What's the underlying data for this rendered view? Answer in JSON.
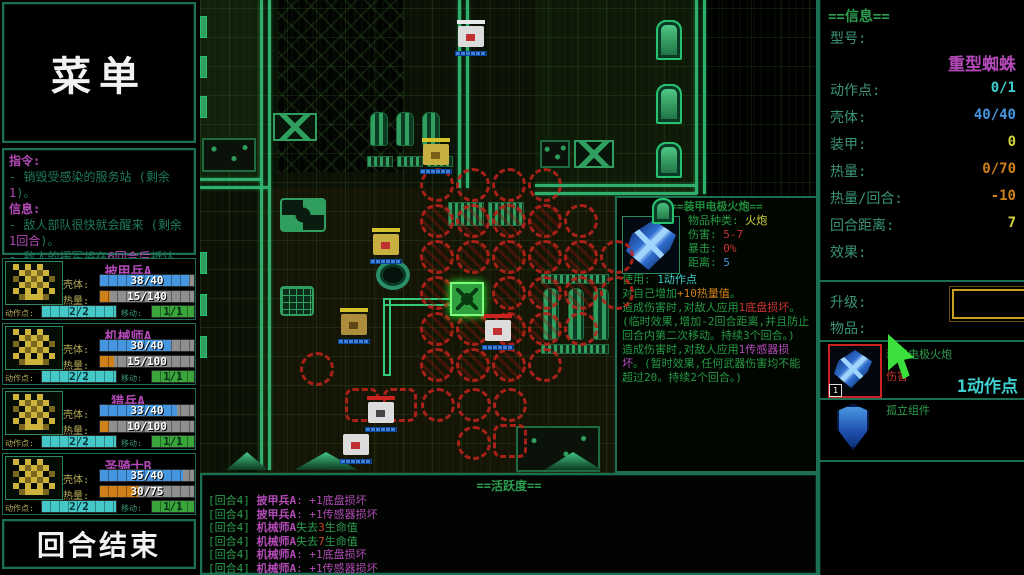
{
  "left_panel": {
    "menu_title": "菜单",
    "orders": {
      "header": "指令:",
      "line1_a": "- 销毁受感染的服务站 (剩余",
      "line1_b": "1",
      "line1_c": ")。"
    },
    "info": {
      "header": "信息:",
      "line1_a": "- 敌人部队很快就会醒来 (剩余",
      "line1_b": "1回合",
      "line1_c": ")。",
      "line2_a": "- 敌人的援军将在",
      "line2_b": "6回合后",
      "line2_c": "抵达。"
    },
    "labels": {
      "shell": "壳体:",
      "heat": "热量:",
      "ap": "动作点:",
      "move": "移动:"
    },
    "units": [
      {
        "name": "披甲兵A",
        "shell": "38/40",
        "shell_pct": 95,
        "heat": "15/140",
        "heat_pct": 11,
        "ap": "2/2",
        "move": "1/1"
      },
      {
        "name": "机械师A",
        "shell": "30/40",
        "shell_pct": 75,
        "heat": "15/100",
        "heat_pct": 15,
        "ap": "2/2",
        "move": "1/1"
      },
      {
        "name": "猎兵A",
        "shell": "33/40",
        "shell_pct": 82,
        "heat": "10/100",
        "heat_pct": 10,
        "ap": "2/2",
        "move": "1/1"
      },
      {
        "name": "圣骑士B",
        "shell": "35/40",
        "shell_pct": 88,
        "heat": "30/75",
        "heat_pct": 40,
        "ap": "2/2",
        "move": "1/1"
      }
    ],
    "end_turn_label": "回合结束"
  },
  "right_panel": {
    "info_title": "==信息==",
    "model_label": "型号:",
    "model_value": "重型蜘蛛",
    "fields": [
      {
        "label": "动作点:",
        "value": "0/1"
      },
      {
        "label": "壳体:",
        "value": "40/40"
      },
      {
        "label": "装甲:",
        "value": "0"
      },
      {
        "label": "热量:",
        "value": "0/70"
      },
      {
        "label": "热量/回合:",
        "value": "-10"
      },
      {
        "label": "回合距离:",
        "value": "7"
      }
    ],
    "effects_label": "效果:",
    "upgrade_label": "升级:",
    "items_label": "物品:",
    "item1": {
      "count": "1",
      "name": "装甲电极火炮",
      "stat_label": "伤害",
      "action_cost": "1动作点"
    },
    "item2": {
      "name": "孤立组件"
    }
  },
  "tooltip": {
    "title": "==装甲电极火炮==",
    "type_label": "物品种类:",
    "type_value": "火炮",
    "damage_label": "伤害:",
    "damage_value": "5-7",
    "crit_label": "暴击:",
    "crit_value": "0%",
    "range_label": "距离:",
    "range_value": "5",
    "use_label": "使用:",
    "use_value": "1动作点",
    "self_a": "对自己增加",
    "self_b": "+10热量值",
    "self_c": "。",
    "p1_a": "造成伤害时,对敌人应用",
    "p1_b": "1底盘损坏",
    "p1_c": "。(临时效果,增加-2回合距离,并且防止回合内第二次移动。持续3个回合。)",
    "p2_a": "造成伤害时,对敌人应用",
    "p2_b": "1传感器损坏",
    "p2_c": "。(暂时效果,任何武器伤害均不能超过20。持续2个回合。)"
  },
  "log": {
    "title": "==活跃度==",
    "lines": [
      {
        "turn": "[回合4]",
        "name": "披甲兵A",
        "a": ": +1底盘损坏",
        "b": "",
        "c": ""
      },
      {
        "turn": "[回合4]",
        "name": "披甲兵A",
        "a": ": +1传感器损坏",
        "b": "",
        "c": ""
      },
      {
        "turn": "[回合4]",
        "name": "机械师A",
        "a": "失去",
        "b": "3",
        "c": "生命值"
      },
      {
        "turn": "[回合4]",
        "name": "机械师A",
        "a": "失去",
        "b": "7",
        "c": "生命值"
      },
      {
        "turn": "[回合4]",
        "name": "机械师A",
        "a": ": +1底盘损坏",
        "b": "",
        "c": ""
      },
      {
        "turn": "[回合4]",
        "name": "机械师A",
        "a": ": +1传感器损坏",
        "b": "",
        "c": ""
      }
    ]
  }
}
